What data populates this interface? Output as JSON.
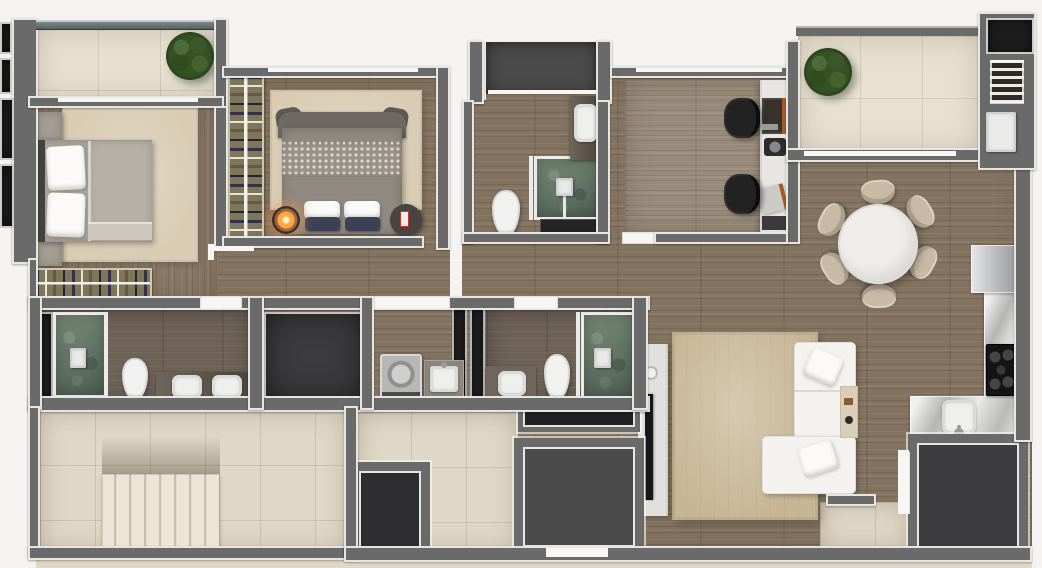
{
  "meta": {
    "type": "apartment-floor-plan-render",
    "view": "top-down",
    "width_px": 1042,
    "height_px": 568,
    "visible_text": "none"
  },
  "palette": {
    "exterior": "#f4f3f1",
    "wall": "#6a6a6a",
    "trim": "#f7f6f3",
    "wood": "#84735f",
    "wood_bed": "#8a7966",
    "wood_light": "#998b7a",
    "wood_dark": "#6e6257",
    "tile": "#e8e1d1",
    "tile_warm": "#e0d8c6",
    "glass": "#4e5d5d",
    "dark_floor": "#3b3b3d",
    "shaft": "#202022",
    "black_panel": "#1d1d1d",
    "green": "#5f7264",
    "green_light": "#798a74",
    "marble": "#d3d3d2",
    "steel": "#c4c6c8",
    "steel_dark": "#97999c",
    "rug": "#d9ccb3",
    "rug_living": "#c7b594",
    "sofa": "#f3f2ef",
    "bed": "#aaa49b",
    "bed2": "#8f8981",
    "wardrobe": "#7e765a",
    "chair": "#c8baa5",
    "table_white": "#efeeeb",
    "counter_brown": "#5a5046",
    "plant": "#365224",
    "plant_dark": "#24381a",
    "lamp_glow": "#ffa844"
  },
  "scene": {
    "rooms": [
      {
        "name": "balcony-master",
        "floor": "beige-tile",
        "features": [
          "glass-railing",
          "potted-plant"
        ]
      },
      {
        "name": "master-bedroom",
        "floor": "wood",
        "features": [
          "double-bed",
          "two-nightstands",
          "rug",
          "open-wardrobe"
        ]
      },
      {
        "name": "bedroom-2",
        "floor": "wood",
        "features": [
          "double-bed",
          "wardrobe-column",
          "rug",
          "glowing-lamp",
          "side-table"
        ]
      },
      {
        "name": "bathroom-1",
        "floor": "wood",
        "features": [
          "vanity-basin",
          "green-tile-shower",
          "toilet",
          "dark-mat",
          "service-shaft"
        ]
      },
      {
        "name": "office",
        "floor": "light-wood",
        "features": [
          "desk-strip",
          "two-office-chairs",
          "laptops"
        ]
      },
      {
        "name": "balcony-2",
        "floor": "beige-tile",
        "features": [
          "potted-plant",
          "glass-railing"
        ]
      },
      {
        "name": "service-column",
        "floor": "none",
        "features": [
          "black-panel",
          "vent-grille",
          "white-appliance"
        ]
      },
      {
        "name": "dining-area",
        "floor": "wood",
        "features": [
          "round-table",
          "six-chairs"
        ]
      },
      {
        "name": "kitchen",
        "floor": "wood",
        "features": [
          "fridge",
          "marble-counter-L",
          "cooktop",
          "sink"
        ]
      },
      {
        "name": "living-room",
        "floor": "wood",
        "features": [
          "sectional-sofa",
          "rug",
          "tv-console",
          "tv"
        ]
      },
      {
        "name": "master-bathroom",
        "floor": "dark-wood",
        "features": [
          "green-tile-shower",
          "toilet",
          "double-basin-vanity"
        ]
      },
      {
        "name": "storage-room",
        "floor": "dark-tile",
        "features": []
      },
      {
        "name": "laundry",
        "floor": "wood",
        "features": [
          "washing-machine",
          "laundry-tub"
        ]
      },
      {
        "name": "bathroom-2",
        "floor": "wood",
        "features": [
          "vanity-basin",
          "toilet",
          "green-tile-shower"
        ]
      },
      {
        "name": "stair-hall",
        "floor": "cream-tile",
        "features": [
          "staircase"
        ]
      },
      {
        "name": "elevator",
        "floor": "steel",
        "features": [
          "elevator-cab",
          "shaft"
        ]
      },
      {
        "name": "utility-dark-room",
        "floor": "dark-tile",
        "features": []
      },
      {
        "name": "entry",
        "floor": "cream-tile",
        "features": [
          "door"
        ]
      }
    ],
    "counts": {
      "dining_chairs": 6,
      "cooktop_burners": 5,
      "stair_treads": 8,
      "office_chairs": 2,
      "plants": 2,
      "toilets": 3,
      "showers": 3,
      "basins": 4
    }
  }
}
